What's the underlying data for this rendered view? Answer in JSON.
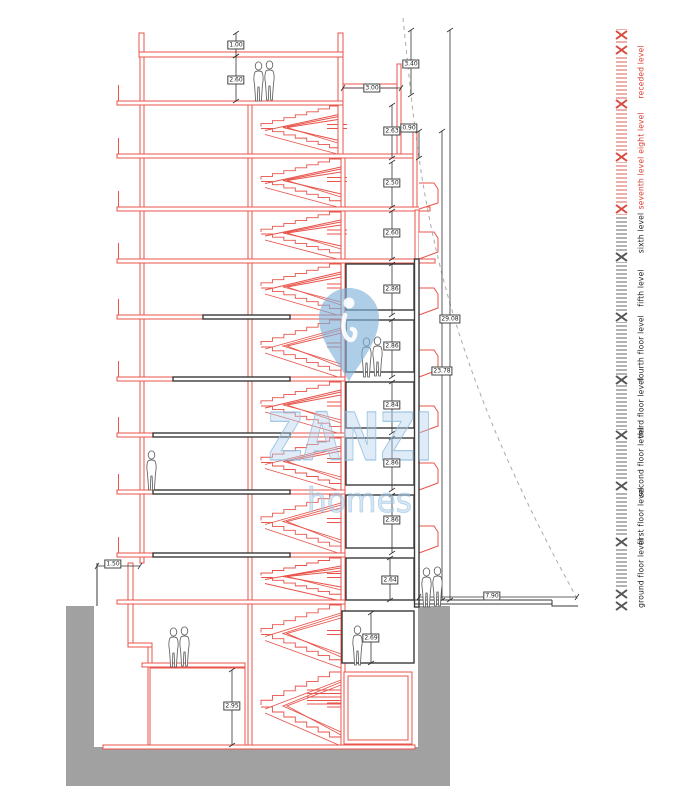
{
  "page": {
    "type": "architectural-section-drawing"
  },
  "colors": {
    "line_red": "#e8534a",
    "line_black": "#3a3a3a",
    "ground_gray": "#a1a1a1",
    "dim_line": "#333333",
    "level_red": "#d93a30",
    "level_black": "#222222",
    "watermark_blue": "#9cc4e4",
    "sight_line_gray": "#aaaaaa"
  },
  "watermark": {
    "brand": "ZANZI",
    "sub": "homes",
    "pin_icon": "location-pin-icon"
  },
  "ruler": {
    "levels": [
      {
        "label": "ground floor level",
        "color": "#222222",
        "y": 573
      },
      {
        "label": "first floor level",
        "color": "#222222",
        "y": 516
      },
      {
        "label": "second floor level",
        "color": "#222222",
        "y": 462
      },
      {
        "label": "third floor level",
        "color": "#222222",
        "y": 408
      },
      {
        "label": "fourth floor level",
        "color": "#222222",
        "y": 348
      },
      {
        "label": "fifth level",
        "color": "#222222",
        "y": 288
      },
      {
        "label": "sixth level",
        "color": "#222222",
        "y": 233
      },
      {
        "label": "seventh level",
        "color": "#d93a30",
        "y": 183
      },
      {
        "label": "eight level",
        "color": "#d93a30",
        "y": 133
      },
      {
        "label": "receded level",
        "color": "#d93a30",
        "y": 72
      }
    ],
    "marks": [
      {
        "y": 35,
        "color": "#d84a40"
      },
      {
        "y": 50,
        "color": "#d84a40"
      },
      {
        "y": 104,
        "color": "#d84a40"
      },
      {
        "y": 157,
        "color": "#d84a40"
      },
      {
        "y": 209,
        "color": "#d84a40"
      },
      {
        "y": 257,
        "color": "#555555"
      },
      {
        "y": 317,
        "color": "#555555"
      },
      {
        "y": 380,
        "color": "#555555"
      },
      {
        "y": 435,
        "color": "#555555"
      },
      {
        "y": 486,
        "color": "#555555"
      },
      {
        "y": 542,
        "color": "#555555"
      },
      {
        "y": 594,
        "color": "#555555"
      },
      {
        "y": 606,
        "color": "#555555"
      }
    ]
  },
  "dimensions": [
    {
      "value": "1.00",
      "o": "v",
      "x": 236,
      "y1": 33,
      "y2": 56,
      "bx": 236,
      "by": 45
    },
    {
      "value": "2.60",
      "o": "v",
      "x": 236,
      "y1": 56,
      "y2": 101,
      "bx": 236,
      "by": 80
    },
    {
      "value": "3.40",
      "o": "v",
      "x": 411,
      "y1": 30,
      "y2": 95,
      "bx": 411,
      "by": 64
    },
    {
      "value": "3.00",
      "o": "h",
      "y": 88,
      "x1": 343,
      "x2": 401,
      "bx": 372,
      "by": 88
    },
    {
      "value": "2.63",
      "o": "v",
      "x": 392,
      "y1": 105,
      "y2": 158,
      "bx": 392,
      "by": 131
    },
    {
      "value": "0.90",
      "o": "v",
      "x": 419,
      "y1": 131,
      "y2": 158,
      "bx": 409,
      "by": 128
    },
    {
      "value": "2.50",
      "o": "v",
      "x": 392,
      "y1": 162,
      "y2": 207,
      "bx": 392,
      "by": 183
    },
    {
      "value": "2.60",
      "o": "v",
      "x": 392,
      "y1": 211,
      "y2": 259,
      "bx": 392,
      "by": 233
    },
    {
      "value": "2.86",
      "o": "v",
      "x": 392,
      "y1": 264,
      "y2": 315,
      "bx": 392,
      "by": 289
    },
    {
      "value": "2.86",
      "o": "v",
      "x": 392,
      "y1": 320,
      "y2": 377,
      "bx": 392,
      "by": 346
    },
    {
      "value": "2.84",
      "o": "v",
      "x": 392,
      "y1": 382,
      "y2": 433,
      "bx": 392,
      "by": 405
    },
    {
      "value": "2.86",
      "o": "v",
      "x": 392,
      "y1": 438,
      "y2": 490,
      "bx": 392,
      "by": 463
    },
    {
      "value": "2.86",
      "o": "v",
      "x": 392,
      "y1": 495,
      "y2": 553,
      "bx": 392,
      "by": 520
    },
    {
      "value": "2.64",
      "o": "v",
      "x": 390,
      "y1": 558,
      "y2": 600,
      "bx": 390,
      "by": 580
    },
    {
      "value": "2.69",
      "o": "v",
      "x": 371,
      "y1": 613,
      "y2": 663,
      "bx": 371,
      "by": 638
    },
    {
      "value": "2.95",
      "o": "v",
      "x": 232,
      "y1": 670,
      "y2": 745,
      "bx": 232,
      "by": 706
    },
    {
      "value": "1.50",
      "o": "h",
      "y": 566,
      "x1": 97,
      "x2": 140,
      "bx": 113,
      "by": 564
    },
    {
      "value": "7.90",
      "o": "h",
      "y": 597,
      "x1": 419,
      "x2": 577,
      "bx": 492,
      "by": 596
    },
    {
      "value": "29.08",
      "o": "v",
      "x": 450,
      "y1": 30,
      "y2": 600,
      "bx": 450,
      "by": 319
    },
    {
      "value": "23.78",
      "o": "v",
      "x": 442,
      "y1": 131,
      "y2": 600,
      "bx": 442,
      "by": 371
    }
  ],
  "figures": [
    {
      "x": 253,
      "y": 62
    },
    {
      "x": 264,
      "y": 61
    },
    {
      "x": 361,
      "y": 338
    },
    {
      "x": 372,
      "y": 337
    },
    {
      "x": 146,
      "y": 451
    },
    {
      "x": 168,
      "y": 628
    },
    {
      "x": 179,
      "y": 627
    },
    {
      "x": 352,
      "y": 626
    },
    {
      "x": 421,
      "y": 568
    },
    {
      "x": 432,
      "y": 567
    }
  ]
}
